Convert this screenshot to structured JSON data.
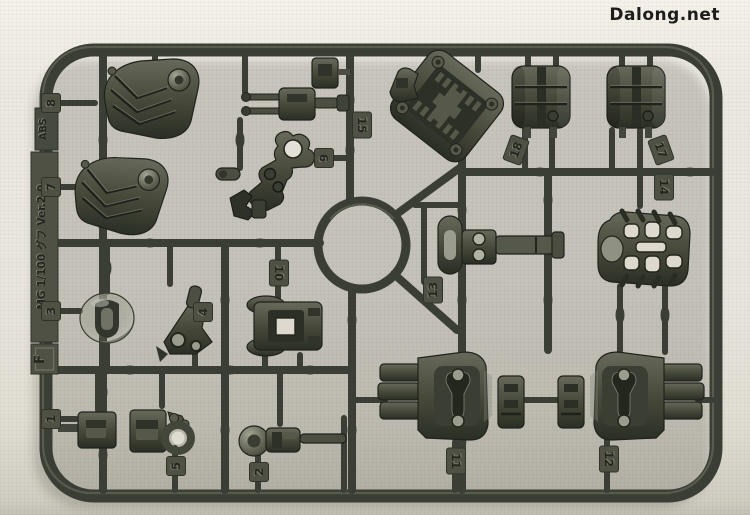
{
  "watermark": {
    "text": "Dalong.net",
    "color": "#1f1d1a"
  },
  "sprue": {
    "runner_letter": "F",
    "kit_label": "MG 1/100 グフ Ver.2.0",
    "material_label": "ABS",
    "plastic_color": "#3b3e34",
    "plastic_highlight": "#767968",
    "plastic_dark": "#2c2f26",
    "tag_plate_color": "#4e5144",
    "background_color": "#e9e6de",
    "part_tags": [
      {
        "label": "8",
        "x": 51,
        "y": 103,
        "rot": -90
      },
      {
        "label": "7",
        "x": 51,
        "y": 187,
        "rot": -90
      },
      {
        "label": "3",
        "x": 51,
        "y": 311,
        "rot": -90
      },
      {
        "label": "1",
        "x": 51,
        "y": 419,
        "rot": -90
      },
      {
        "label": "9",
        "x": 324,
        "y": 158,
        "rot": -90
      },
      {
        "label": "15",
        "x": 362,
        "y": 125,
        "rot": 90
      },
      {
        "label": "18",
        "x": 516,
        "y": 150,
        "rot": -70
      },
      {
        "label": "17",
        "x": 661,
        "y": 150,
        "rot": 70
      },
      {
        "label": "14",
        "x": 664,
        "y": 187,
        "rot": 90
      },
      {
        "label": "13",
        "x": 433,
        "y": 290,
        "rot": -90
      },
      {
        "label": "10",
        "x": 279,
        "y": 273,
        "rot": 90
      },
      {
        "label": "4",
        "x": 203,
        "y": 312,
        "rot": -90
      },
      {
        "label": "5",
        "x": 176,
        "y": 466,
        "rot": -90
      },
      {
        "label": "2",
        "x": 259,
        "y": 472,
        "rot": -90
      },
      {
        "label": "11",
        "x": 456,
        "y": 461,
        "rot": 90
      },
      {
        "label": "12",
        "x": 609,
        "y": 459,
        "rot": 90
      }
    ]
  }
}
